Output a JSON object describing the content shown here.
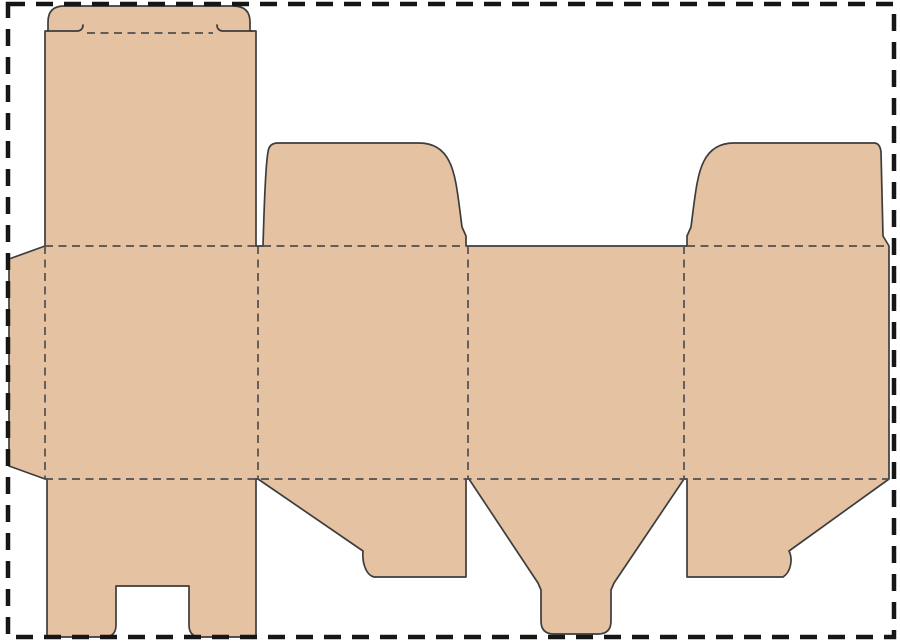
{
  "canvas": {
    "width": 900,
    "height": 643,
    "background": "#ffffff",
    "description": "Folding-carton box dieline template (tuck-top lid, dust flaps, snap-lock bottom) shown flat inside a dashed page boundary"
  },
  "colors": {
    "board_fill": "#e5c2a2",
    "cut_line": "#3d3d3d",
    "fold_line": "#4f4f4f",
    "page_border": "#161616"
  },
  "strokes": {
    "cut_width": 1.7,
    "fold_width": 1.7,
    "fold_dash": "8 5.5",
    "border_width": 4.5,
    "border_dash": "17 11"
  },
  "page_border": {
    "name": "page-border",
    "x": 8,
    "y": 4,
    "width": 886,
    "height": 633
  },
  "dieline": {
    "outline": {
      "name": "carton-blank-outline",
      "d": "M 64,6 L 233,6 Q 250,6 250,22 L 250,31 L 256,31 L 256,246 L 263,246 C 264,215 265,168 268,152 Q 269,143 278,143 L 419,143 Q 440,143 449,161 C 456,174 458,196 462,227 L 466,236 L 466,246 L 687,246 L 687,236 L 691,227 C 695,196 697,174 704,161 Q 713,143 734,143 L 874,143 Q 880,143 881,152 L 883,236 L 889,246 L 889,479 L 789,551 C 793,559 791,572 783,577 L 687,577 L 687,479 L 684,479 L 614,583 L 611,590 L 611,621 Q 611,634 598,634 L 554,634 Q 541,634 541,621 L 541,590 L 538,583 L 469,479 L 466,479 L 466,577 L 374,577 C 366,575 362,563 363,551 L 258,479 L 256,479 L 256,637 L 201,637 Q 189,637 189,625 L 189,586 L 116,586 L 116,625 Q 116,637 104,637 L 47,637 L 47,479 L 45,479 L 9,466 L 9,259 L 45,246 L 45,31 L 48,31 L 48,22 Q 48,6 64,6 Z"
    },
    "slits": [
      {
        "name": "tuck-flap-slit-left",
        "d": "M 48,31 L 78,31 Q 83,30 83,25"
      },
      {
        "name": "tuck-flap-slit-right",
        "d": "M 252,31 L 222,31 Q 217,30 217,25"
      }
    ],
    "fold_lines": [
      {
        "name": "tuck-flap-fold",
        "x1": 87,
        "y1": 33,
        "x2": 213,
        "y2": 33
      },
      {
        "name": "top-fold-lid-panel",
        "x1": 45,
        "y1": 246,
        "x2": 258,
        "y2": 246
      },
      {
        "name": "top-fold-dust-flap-left",
        "x1": 263,
        "y1": 246,
        "x2": 466,
        "y2": 246
      },
      {
        "name": "top-fold-dust-flap-right",
        "x1": 687,
        "y1": 246,
        "x2": 889,
        "y2": 246
      },
      {
        "name": "bottom-fold",
        "x1": 45,
        "y1": 479,
        "x2": 889,
        "y2": 479
      },
      {
        "name": "glue-flap-fold",
        "x1": 45,
        "y1": 246,
        "x2": 45,
        "y2": 479
      },
      {
        "name": "panel-fold-1",
        "x1": 258,
        "y1": 246,
        "x2": 258,
        "y2": 479
      },
      {
        "name": "panel-fold-2",
        "x1": 468,
        "y1": 246,
        "x2": 468,
        "y2": 479
      },
      {
        "name": "panel-fold-3",
        "x1": 684,
        "y1": 246,
        "x2": 684,
        "y2": 479
      }
    ]
  }
}
